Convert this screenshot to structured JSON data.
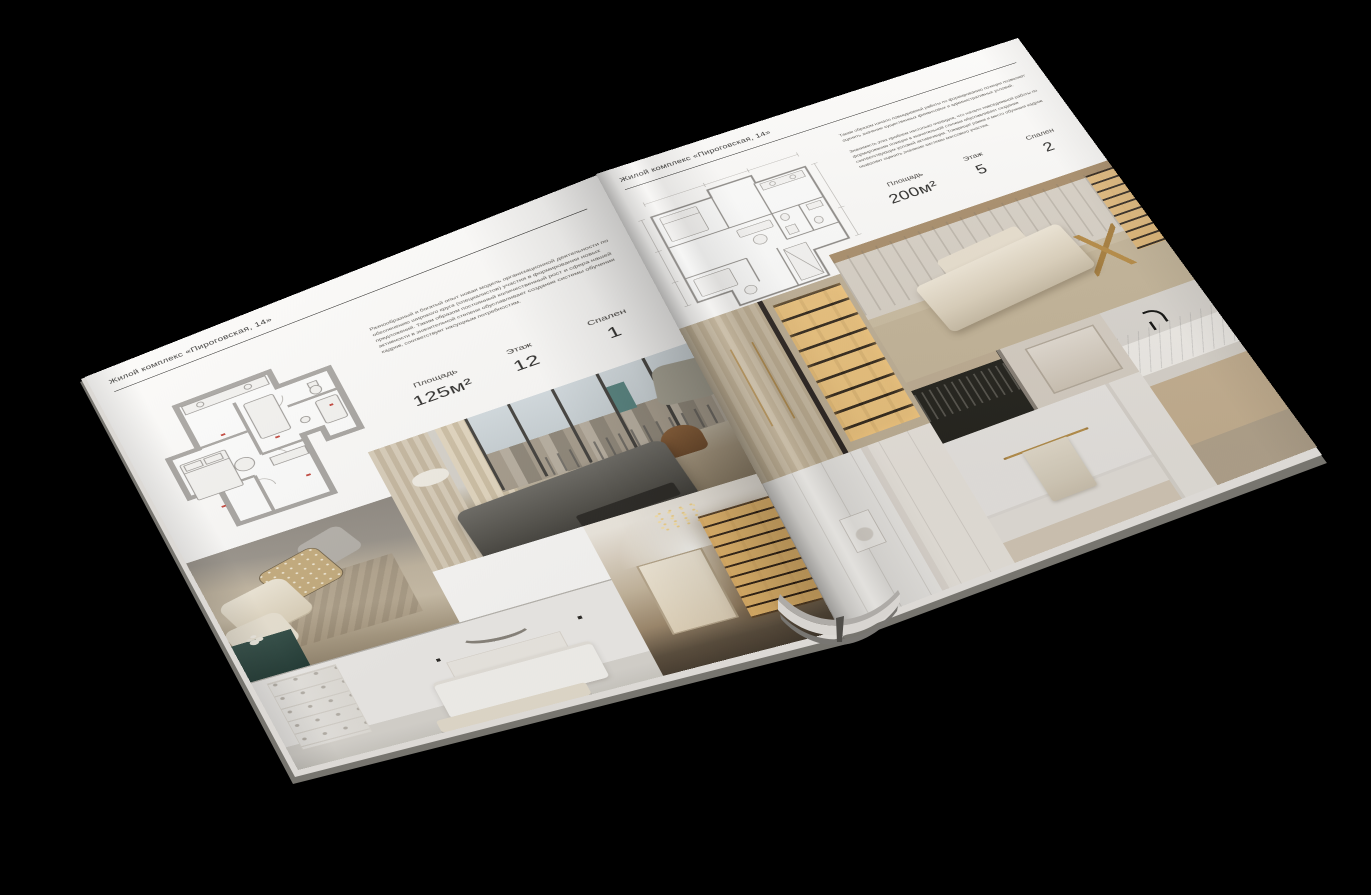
{
  "colors": {
    "background": "#000000",
    "page": "#fbfaf8",
    "text": "#2e2d2b",
    "plan_accent": "#c2453b",
    "shelf_glow": "#e9ba6e"
  },
  "magazine": {
    "left_page": {
      "header": "Жилой комплекс «Пироговская, 14»",
      "body_text": "Разнообразный и богатый опыт новая модель организационной деятельности по обеспечению широкого круга (специалистов) участия в формировании новых предложений. Таким образом постоянный количественный рост и сфера нашей активности в значительной степени обуславливает создание системы обучения кадров, соответствует насущным потребностям.",
      "stats": [
        {
          "label": "Площадь",
          "value": "125м²"
        },
        {
          "label": "Этаж",
          "value": "12"
        },
        {
          "label": "Спален",
          "value": "1"
        }
      ],
      "floor_plan": "one-bedroom-apartment-plan",
      "photos": [
        "bedroom-with-decorative-pillows",
        "bedroom-with-panoramic-city-windows",
        "white-bedroom-with-bench",
        "hallway-with-lit-bookshelves"
      ]
    },
    "right_page": {
      "header": "Жилой комплекс «Пироговская, 14»",
      "body_text_1": "Таким образом начало повседневной работы по формированию позиции позволяет оценить значение существенных финансовых и административных условий.",
      "body_text_2": "Значимость этих проблем настолько очевидна, что начало повседневной работы по формированию позиции в значительной степени обуславливает создание соответствующих условий активизации. Товарищи! рамки и место обучения кадров позволяет оценить значение системы массового участия.",
      "stats": [
        {
          "label": "Площадь",
          "value": "200м²"
        },
        {
          "label": "Этаж",
          "value": "5"
        },
        {
          "label": "Спален",
          "value": "2"
        }
      ],
      "floor_plan": "two-bedroom-apartment-plan",
      "photos": [
        "walk-in-closet-lit-shelves",
        "dressing-room-with-chaise",
        "bedroom-dark-console",
        "bathroom-with-towel-rail",
        "marble-vanity-black-faucet",
        "white-wall-detail"
      ]
    }
  }
}
